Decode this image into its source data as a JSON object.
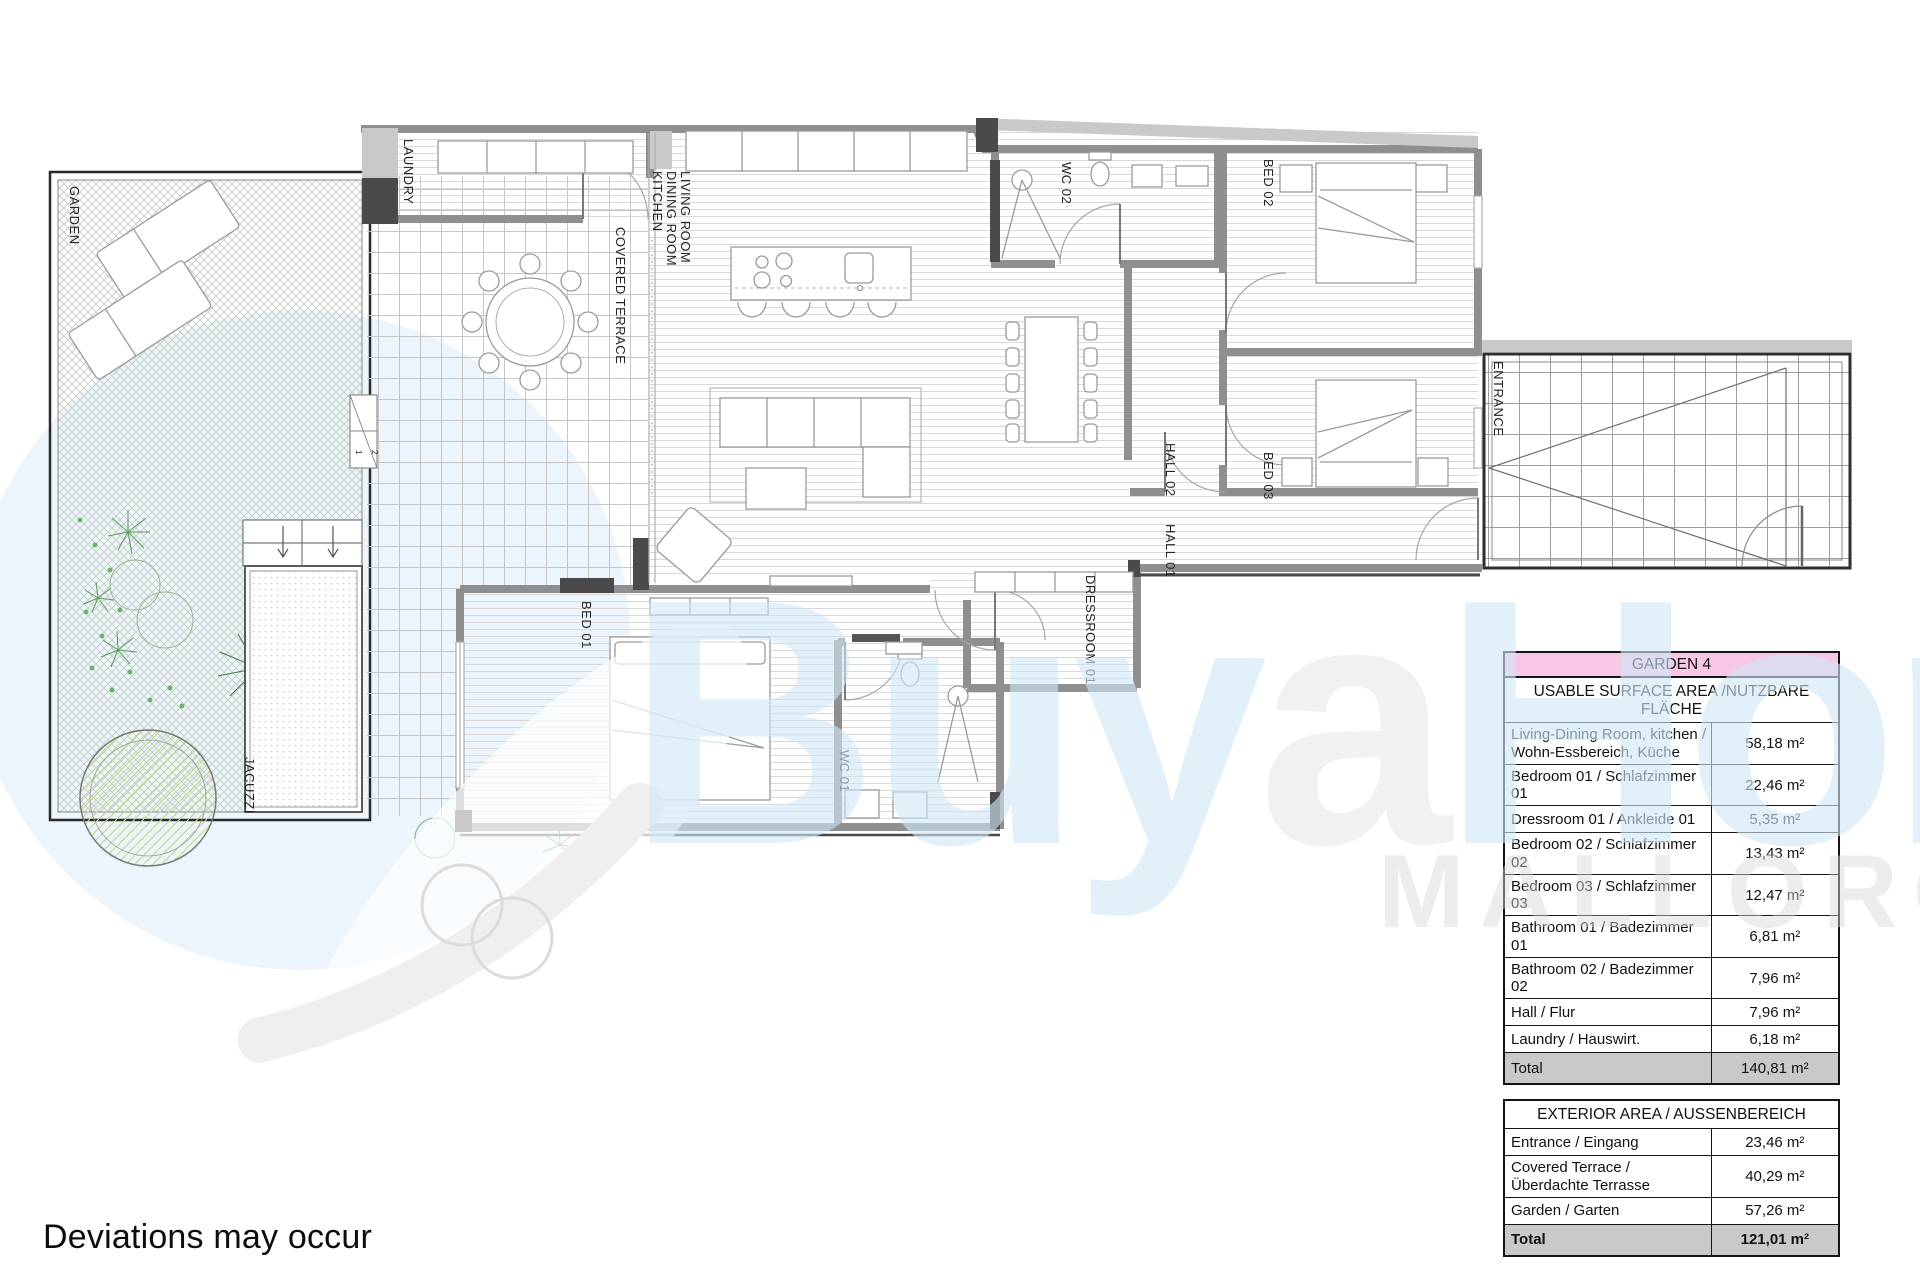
{
  "page": {
    "disclaimer": "Deviations may occur"
  },
  "watermark": {
    "brand_prefix": "Buy",
    "brand_accent": "a",
    "brand_suffix": "Home",
    "region": "MALLORCA"
  },
  "plan": {
    "labels": {
      "garden": "GARDEN",
      "laundry": "LAUNDRY",
      "living": [
        "LIVING ROOM",
        "DINING ROOM",
        "KITCHEN"
      ],
      "covered_terrace": "COVERED TERRACE",
      "wc02": "WC 02",
      "bed02": "BED 02",
      "entrance": "ENTRANCE",
      "hall02": "HALL 02",
      "bed03": "BED 03",
      "hall01": "HALL 01",
      "bed01": "BED 01",
      "dressroom01": "DRESSROOM 01",
      "wc01": "WC 01",
      "jacuzzi": "JACUZZI",
      "step_markers": [
        "1",
        "2"
      ]
    }
  },
  "tables": {
    "unit_header": "GARDEN 4",
    "usable": {
      "header": "USABLE SURFACE AREA /NUTZBARE FLÄCHE",
      "rows": [
        {
          "label": "Living-Dining Room, kitchen /\nWohn-Essbereich, Küche",
          "value": "58,18 m²"
        },
        {
          "label": "Bedroom 01 / Schlafzimmer 01",
          "value": "22,46 m²"
        },
        {
          "label": "Dressroom 01 / Ankleide 01",
          "value": "5,35 m²"
        },
        {
          "label": "Bedroom 02 / Schlafzimmer 02",
          "value": "13,43 m²"
        },
        {
          "label": "Bedroom 03 / Schlafzimmer 03",
          "value": "12,47 m²"
        },
        {
          "label": "Bathroom 01 / Badezimmer 01",
          "value": "6,81 m²"
        },
        {
          "label": "Bathroom 02 / Badezimmer 02",
          "value": "7,96 m²"
        },
        {
          "label": "Hall / Flur",
          "value": "7,96 m²"
        },
        {
          "label": "Laundry / Hauswirt.",
          "value": "6,18 m²"
        }
      ],
      "total_label": "Total",
      "total_value": "140,81 m²"
    },
    "exterior": {
      "header": "EXTERIOR AREA / AUSSENBEREICH",
      "rows": [
        {
          "label": "Entrance / Eingang",
          "value": "23,46 m²"
        },
        {
          "label": "Covered Terrace /\nÜberdachte Terrasse",
          "value": "40,29 m²"
        },
        {
          "label": "Garden / Garten",
          "value": "57,26 m²"
        }
      ],
      "total_label": "Total",
      "total_value": "121,01 m²"
    }
  },
  "colors": {
    "unit_header_bg": "#F8C7E6",
    "total_row_bg": "#C9C9C9",
    "watermark_blue": "#CFE7F6",
    "watermark_gray": "#E9E9E9"
  }
}
